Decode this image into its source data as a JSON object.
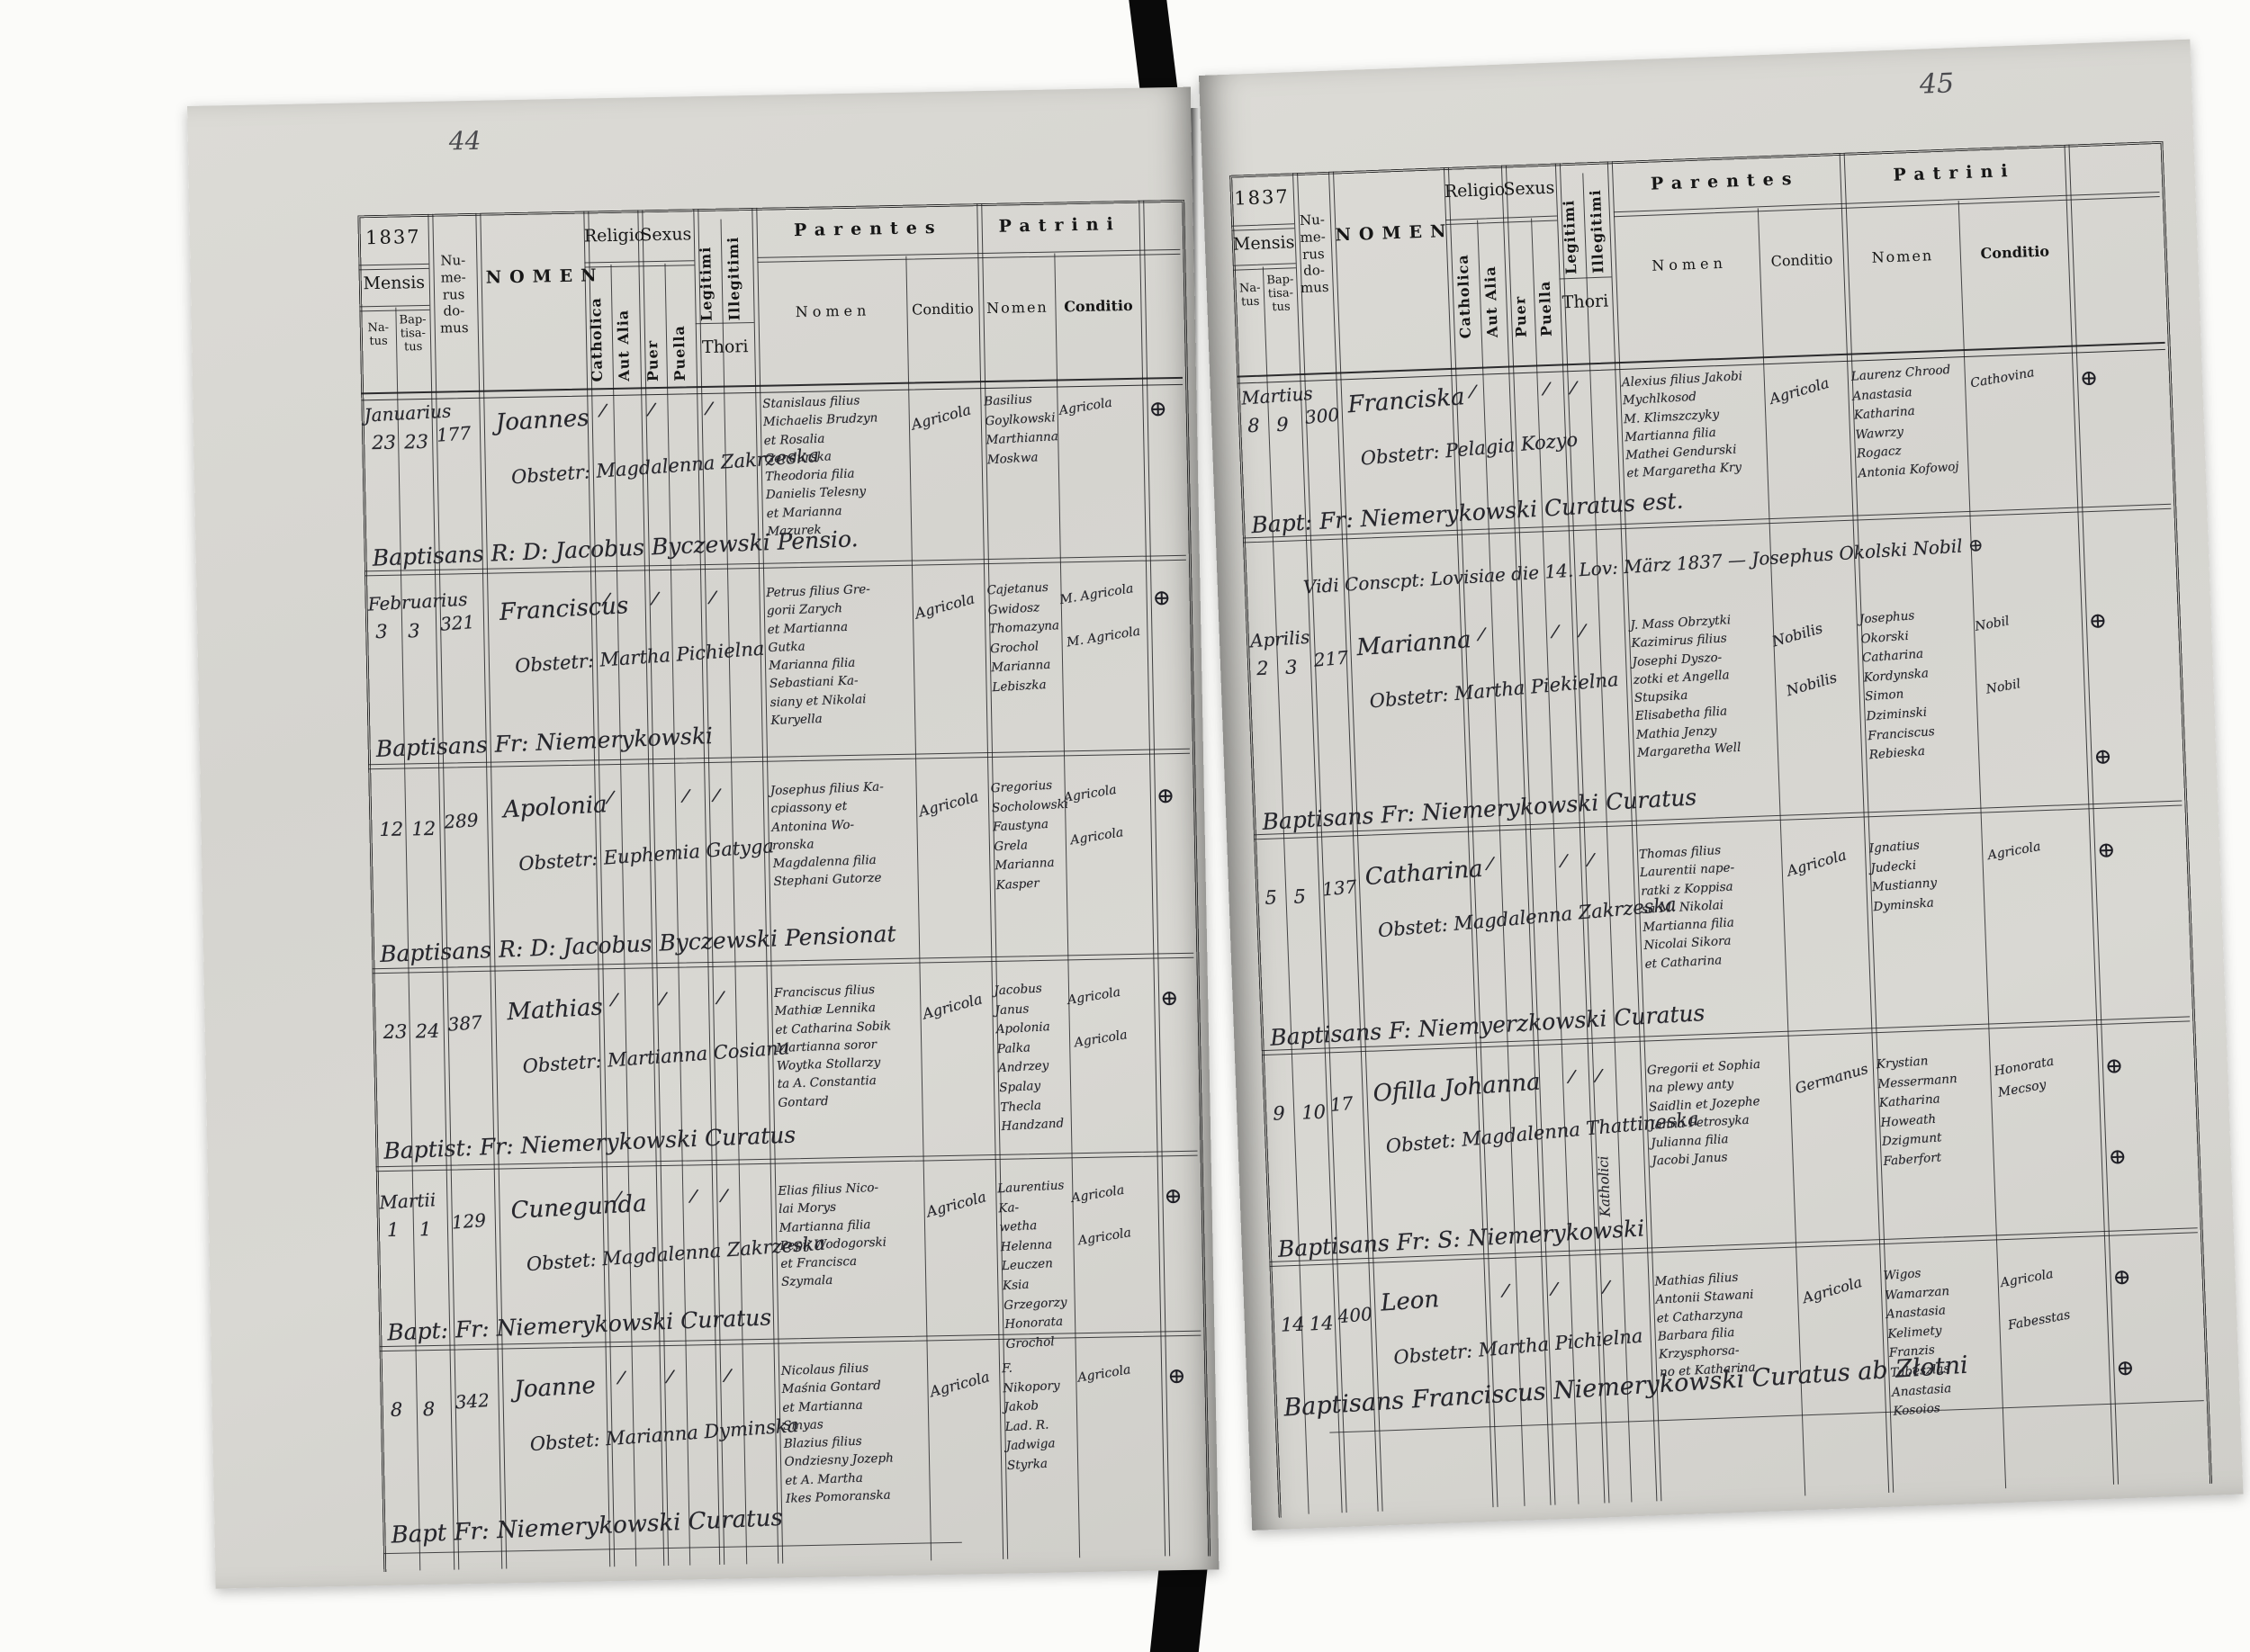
{
  "scan": {
    "left_page_number": "44",
    "right_page_number": "45"
  },
  "header": {
    "year": "1837",
    "mensis": "Mensis",
    "natus": "Na-tus",
    "baptisatus": "Bap-tisa-tus",
    "numerus_domus": "Nu-me-rus do-mus",
    "nomen": "NOMEN",
    "religio": "Religio",
    "catholica": "Catholica",
    "aut_alia": "Aut Alia",
    "sexus": "Sexus",
    "puer": "Puer",
    "puella": "Puella",
    "legitimi": "Legitimi",
    "illegitimi": "Illegitimi",
    "thori": "Thori",
    "parentes": "Parentes",
    "patrini": "Patrini",
    "nomen_sub": "Nomen",
    "conditio_sub": "Conditio"
  },
  "left_page": {
    "entries": [
      {
        "mensis": "Januarius",
        "natus": "23",
        "baptisatus": "23",
        "numerus": "177",
        "nomen": "Joannes",
        "obstetrix": "Obstetr: Magdalenna Zakrzeska",
        "tick_catholica": "/",
        "tick_puer": "/",
        "tick_puella": "",
        "tick_legitimi": "/",
        "parentes": "Stanislaus filius\nMichaelis Brudzyn\net Rosalia\nGendurska\nTheodoria filia\nDanielis Telesny\net Marianna\nMazurek",
        "parentes_conditio": "Agricola",
        "patrini": "Basilius\nGoylkowski\nMarthianna\nMoskwa",
        "patrini_conditio": "Agricola",
        "mark": "⊕",
        "baptisans": "Baptisans R: D: Jacobus Byczewski Pensio."
      },
      {
        "mensis": "Februarius",
        "natus": "3",
        "baptisatus": "3",
        "numerus": "321",
        "nomen": "Franciscus",
        "obstetrix": "Obstetr: Martha Pichielna",
        "tick_catholica": "/",
        "tick_puer": "/",
        "tick_puella": "",
        "tick_legitimi": "/",
        "parentes": "Petrus filius Gre-\ngorii Zarych\net Martianna\nGutka\nMarianna filia\nSebastiani Ka-\nsiany et Nikolai\nKuryella",
        "parentes_conditio": "Agricola",
        "patrini": "Cajetanus\nGwidosz\nThomazyna\nGrochol\nMarianna\nLebiszka",
        "patrini_conditio": "M. Agricola\n\nM. Agricola",
        "mark": "⊕",
        "baptisans": "Baptisans Fr: Niemerykowski"
      },
      {
        "mensis": "",
        "natus": "12",
        "baptisatus": "12",
        "numerus": "289",
        "nomen": "Apolonia",
        "obstetrix": "Obstetr: Euphemia Gatyga",
        "tick_catholica": "/",
        "tick_puer": "",
        "tick_puella": "/",
        "tick_legitimi": "/",
        "parentes": "Josephus filius Ka-\ncpiassony et\nAntonina Wo-\nronska\nMagdalenna filia\nStephani Gutorze",
        "parentes_conditio": "Agricola",
        "patrini": "Gregorius\nSocholowski\nFaustyna\nGrela\nMarianna Kasper",
        "patrini_conditio": "Agricola\n\nAgricola",
        "mark": "⊕",
        "baptisans": "Baptisans R: D: Jacobus Byczewski Pensionat"
      },
      {
        "mensis": "",
        "natus": "23",
        "baptisatus": "24",
        "numerus": "387",
        "nomen": "Mathias",
        "obstetrix": "Obstetr: Martianna Cosiana",
        "tick_catholica": "/",
        "tick_puer": "/",
        "tick_puella": "",
        "tick_legitimi": "/",
        "parentes": "Franciscus filius\nMathiæ Lennika\net Catharina Sobik\nMartianna soror\nWoytka Stollarzy\nta A. Constantia\nGontard",
        "parentes_conditio": "Agricola",
        "patrini": "Jacobus Janus\nApolonia\nPalka\nAndrzey\nSpalay\nThecla Handzand",
        "patrini_conditio": "Agricola\n\nAgricola",
        "mark": "⊕",
        "baptisans": "Baptist: Fr: Niemerykowski Curatus"
      },
      {
        "mensis": "Martii",
        "natus": "1",
        "baptisatus": "1",
        "numerus": "129",
        "nomen": "Cunegunda",
        "obstetrix": "Obstet: Magdalenna Zakrzeska",
        "tick_catholica": "/",
        "tick_puer": "",
        "tick_puella": "/",
        "tick_legitimi": "/",
        "parentes": "Elias filius Nico-\nlai Morys\nMartianna filia\nPepij Wodogorski\net Francisca\nSzymala",
        "parentes_conditio": "Agricola",
        "patrini": "Laurentius Ka-\nwetha Helenna\nLeuczen Ksia\nGrzegorzy\nHonorata\nGrochol",
        "patrini_conditio": "Agricola\n\nAgricola",
        "mark": "⊕",
        "baptisans": "Bapt: Fr: Niemerykowski Curatus"
      },
      {
        "mensis": "",
        "natus": "8",
        "baptisatus": "8",
        "numerus": "342",
        "nomen": "Joanne",
        "obstetrix": "Obstet: Marianna Dyminska",
        "tick_catholica": "/",
        "tick_puer": "/",
        "tick_puella": "",
        "tick_legitimi": "/",
        "parentes": "Nicolaus filius\nMaśnia Gontard\net Martianna\nSmyas\nBlazius filius\nOndziesny Jozeph\net A. Martha\nIkes Pomoranska",
        "parentes_conditio": "Agricola",
        "patrini": "F. Nikopory\nJakob\nLad. R.\nJadwiga\nStyrka",
        "patrini_conditio": "Agricola",
        "mark": "⊕",
        "baptisans": ""
      }
    ],
    "footer_signature": "Bapt Fr: Niemerykowski Curatus"
  },
  "right_page": {
    "visitation_note": "Vidi Conscpt: Lovisiae die 14. Lov: März 1837 — Josephus Okolski Nobil ⊕",
    "entries": [
      {
        "mensis": "Martius",
        "natus": "8",
        "baptisatus": "9",
        "numerus": "300",
        "nomen": "Franciska",
        "obstetrix": "Obstetr: Pelagia Kozyo",
        "tick_catholica": "/",
        "tick_puer": "",
        "tick_puella": "/",
        "tick_legitimi": "/",
        "vertical_note": "",
        "parentes": "Alexius filius Jakobi\nMychlkosod\nM. Klimszczyky\nMartianna filia\nMathei Gendurski\net Margaretha Kry",
        "parentes_conditio": "Agricola",
        "patrini": "Laurenz Chrood\nAnastasia\nKatharina\nWawrzy\nRogacz\nAntonia Kofowoj",
        "patrini_conditio": "Cathovina",
        "mark": "⊕",
        "baptisans": "Bapt: Fr: Niemerykowski Curatus est."
      },
      {
        "mensis": "Aprilis",
        "natus": "2",
        "baptisatus": "3",
        "numerus": "217",
        "nomen": "Marianna",
        "obstetrix": "Obstetr: Martha Piekielna",
        "tick_catholica": "/",
        "tick_puer": "",
        "tick_puella": "/",
        "tick_legitimi": "/",
        "vertical_note": "",
        "parentes": "J. Mass Obrzytki\nKazimirus filius\nJosephi Dyszo-\nzotki et Angella\nStupsika\nElisabetha filia\nMathia Jenzy\nMargaretha Well",
        "parentes_conditio": "Nobilis\n\n\nNobilis",
        "patrini": "Josephus\nOkorski\nCatharina\nKordynska\nSimon\nDziminski\nFranciscus\nRebieska",
        "patrini_conditio": "Nobil\n\n\nNobil",
        "mark": "⊕\n\n\n⊕",
        "baptisans": "Baptisans Fr: Niemerykowski Curatus"
      },
      {
        "mensis": "",
        "natus": "5",
        "baptisatus": "5",
        "numerus": "137",
        "nomen": "Catharina",
        "obstetrix": "Obstet: Magdalenna Zakrzeska",
        "tick_catholica": "/",
        "tick_puer": "",
        "tick_puella": "/",
        "tick_legitimi": "/",
        "vertical_note": "",
        "parentes": "Thomas filius\nLaurentii nape-\nratki z Koppisa\nsa M. Nikolai\nMartianna filia\nNicolai Sikora\net Catharina",
        "parentes_conditio": "Agricola",
        "patrini": "Ignatius\nJudecki\nMustianny\nDyminska",
        "patrini_conditio": "Agricola",
        "mark": "⊕",
        "baptisans": "Baptisans F: Niemyerzkowski Curatus"
      },
      {
        "mensis": "",
        "natus": "9",
        "baptisatus": "10",
        "numerus": "17",
        "nomen": "Ofilla Johanna",
        "obstetrix": "Obstet: Magdalenna Thattineska",
        "tick_catholica": "",
        "tick_puer": "",
        "tick_puella": "/",
        "tick_legitimi": "/",
        "vertical_note": "Katholici",
        "parentes": "Gregorii et Sophia\nna plewy anty\nSaidlin et Jozephe\nJanna Petrosyka\nJulianna filia\nJacobi Janus",
        "parentes_conditio": "Germanus",
        "patrini": "Krystian Messermann\nKatharina\nHoweath\nDzigmunt\nFaberfort",
        "patrini_conditio": "Honorata\nMecsoy",
        "mark": "⊕\n\n⊕",
        "baptisans": "Baptisans Fr: S: Niemerykowski"
      },
      {
        "mensis": "",
        "natus": "14",
        "baptisatus": "14",
        "numerus": "400",
        "nomen": "Leon",
        "obstetrix": "Obstetr: Martha Pichielna",
        "tick_catholica": "/",
        "tick_puer": "/",
        "tick_puella": "",
        "tick_legitimi": "/",
        "vertical_note": "",
        "parentes": "Mathias filius\nAntonii Stawani\net Catharzyna\nBarbara filia\nKrzysphorsa-\nno et Katharina",
        "parentes_conditio": "Agricola",
        "patrini": "Wigos\nWamarzan\nAnastasia\nKelimety\nFranzis\nTabeszlas\nAnastasia\nKosoios",
        "patrini_conditio": "Agricola\n\nFabesstas",
        "mark": "⊕\n\n⊕",
        "baptisans": ""
      }
    ],
    "footer_signature": "Baptisans Franciscus Niemerykowski Curatus ab Złotni"
  }
}
